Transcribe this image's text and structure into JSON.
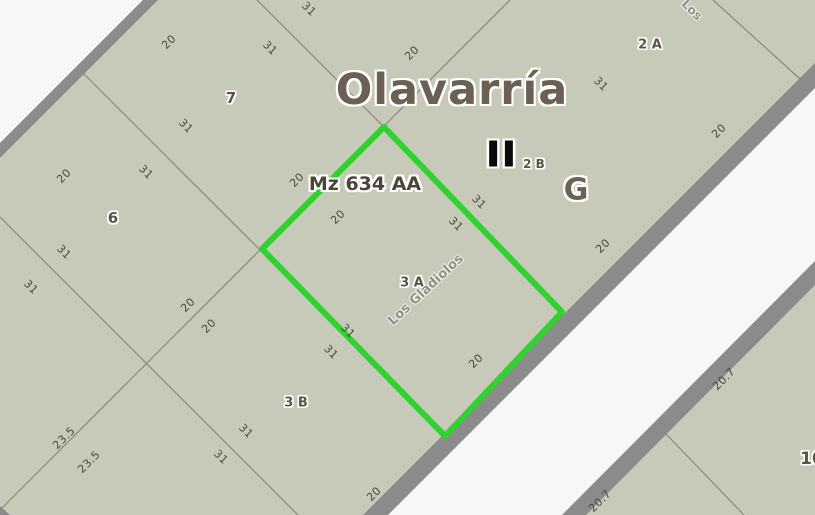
{
  "map": {
    "title": "Olavarría",
    "manzana_label": "Mz 634 AA",
    "section_numeral": "II",
    "zone_letter": "G",
    "highlight_color": "#30d230",
    "parcel_fill": "#c8cab9",
    "road_fill": "#f7f7f6",
    "road_border": "#8b8b8b",
    "line_color": "#8a8876"
  },
  "map_labels": [
    {
      "text": "20",
      "x": 169,
      "y": 42,
      "rot": -45,
      "kind": "dim"
    },
    {
      "text": "31",
      "x": 270,
      "y": 48,
      "rot": 45,
      "kind": "dim"
    },
    {
      "text": "31",
      "x": 309,
      "y": 9,
      "rot": 45,
      "kind": "dim"
    },
    {
      "text": "20",
      "x": 412,
      "y": 53,
      "rot": -45,
      "kind": "dim"
    },
    {
      "text": "31",
      "x": 601,
      "y": 84,
      "rot": 45,
      "kind": "dim"
    },
    {
      "text": "20",
      "x": 719,
      "y": 131,
      "rot": -45,
      "kind": "dim"
    },
    {
      "text": "20",
      "x": 603,
      "y": 246,
      "rot": -45,
      "kind": "dim"
    },
    {
      "text": "31",
      "x": 186,
      "y": 126,
      "rot": 45,
      "kind": "dim"
    },
    {
      "text": "20",
      "x": 64,
      "y": 176,
      "rot": -45,
      "kind": "dim"
    },
    {
      "text": "31",
      "x": 146,
      "y": 172,
      "rot": 45,
      "kind": "dim"
    },
    {
      "text": "31",
      "x": 64,
      "y": 252,
      "rot": 45,
      "kind": "dim"
    },
    {
      "text": "31",
      "x": 31,
      "y": 287,
      "rot": 45,
      "kind": "dim"
    },
    {
      "text": "20",
      "x": 188,
      "y": 305,
      "rot": -45,
      "kind": "dim"
    },
    {
      "text": "20",
      "x": 209,
      "y": 326,
      "rot": -45,
      "kind": "dim"
    },
    {
      "text": "20",
      "x": 297,
      "y": 180,
      "rot": -45,
      "kind": "dim"
    },
    {
      "text": "20",
      "x": 338,
      "y": 217,
      "rot": -45,
      "kind": "dim"
    },
    {
      "text": "31",
      "x": 456,
      "y": 224,
      "rot": 45,
      "kind": "dim"
    },
    {
      "text": "31",
      "x": 479,
      "y": 202,
      "rot": 45,
      "kind": "dim"
    },
    {
      "text": "31",
      "x": 348,
      "y": 331,
      "rot": 45,
      "kind": "dim"
    },
    {
      "text": "31",
      "x": 331,
      "y": 352,
      "rot": 45,
      "kind": "dim"
    },
    {
      "text": "20",
      "x": 476,
      "y": 361,
      "rot": -45,
      "kind": "dim"
    },
    {
      "text": "31",
      "x": 246,
      "y": 431,
      "rot": 45,
      "kind": "dim"
    },
    {
      "text": "31",
      "x": 221,
      "y": 457,
      "rot": 45,
      "kind": "dim"
    },
    {
      "text": "23.5",
      "x": 64,
      "y": 438,
      "rot": -45,
      "kind": "dim"
    },
    {
      "text": "23.5",
      "x": 89,
      "y": 462,
      "rot": -45,
      "kind": "dim"
    },
    {
      "text": "20",
      "x": 374,
      "y": 494,
      "rot": -45,
      "kind": "dim"
    },
    {
      "text": "20.7",
      "x": 724,
      "y": 379,
      "rot": -45,
      "kind": "dim"
    },
    {
      "text": "20.7",
      "x": 600,
      "y": 501,
      "rot": -45,
      "kind": "dim"
    },
    {
      "text": "7",
      "x": 231,
      "y": 98,
      "rot": 0,
      "kind": "parcel-id",
      "fs": 15
    },
    {
      "text": "6",
      "x": 113,
      "y": 218,
      "rot": 0,
      "kind": "parcel-id",
      "fs": 15
    },
    {
      "text": "2 A",
      "x": 650,
      "y": 45,
      "rot": 0,
      "kind": "parcel-id",
      "fs": 13
    },
    {
      "text": "2 B",
      "x": 534,
      "y": 164,
      "rot": 0,
      "kind": "parcel-id",
      "fs": 12
    },
    {
      "text": "3 A",
      "x": 412,
      "y": 283,
      "rot": 0,
      "kind": "parcel-id",
      "fs": 13
    },
    {
      "text": "3 B",
      "x": 296,
      "y": 403,
      "rot": 0,
      "kind": "parcel-id",
      "fs": 13
    },
    {
      "text": "10",
      "x": 812,
      "y": 459,
      "rot": 0,
      "kind": "parcel-id",
      "fs": 17
    },
    {
      "text": "Los Gladiolos",
      "x": 426,
      "y": 290,
      "rot": -43,
      "kind": "street",
      "fs": 13
    },
    {
      "text": "Los",
      "x": 692,
      "y": 10,
      "rot": 45,
      "kind": "street",
      "fs": 12
    }
  ]
}
